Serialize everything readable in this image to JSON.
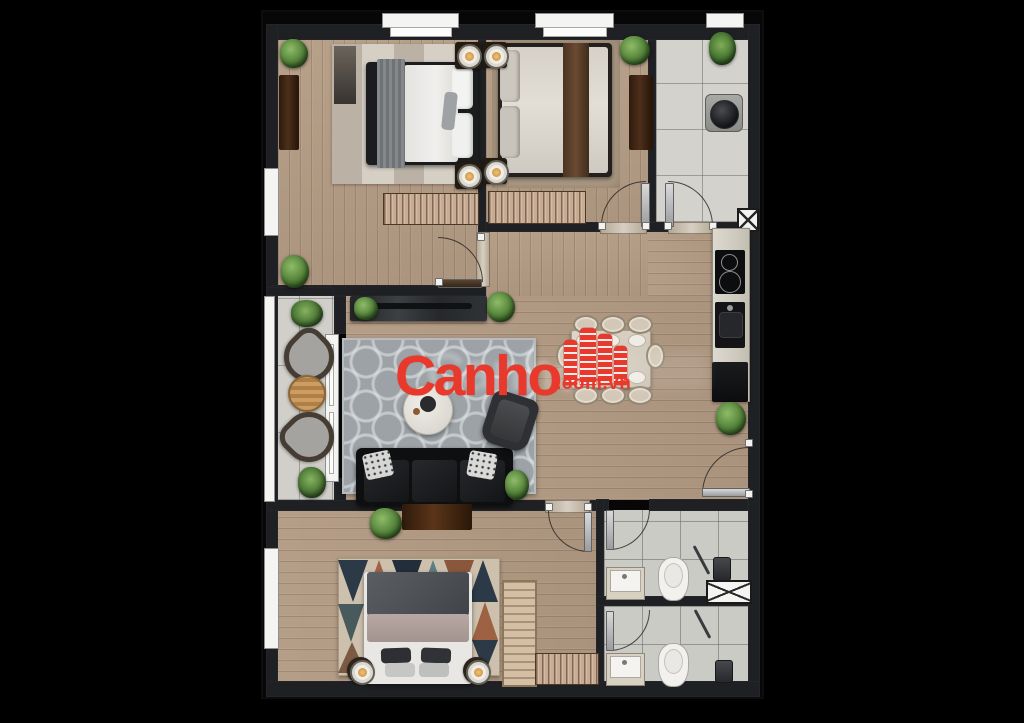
{
  "watermark": {
    "brand": "Canho",
    "suffix": ".com.vn",
    "ghost": "Canho",
    "brand_color": "#e8392c"
  },
  "palette": {
    "background": "#000000",
    "wall": "#1f2023",
    "wood_floor": "#b49c84",
    "tile_floor": "#d2d1cc",
    "bath_tile": "#cbcbc6",
    "rug_living": "#9ca2a6",
    "sofa_leather": "#151618",
    "threshold_marble": "#c9bfae",
    "plant_green": "#4f7e36",
    "window_white": "#f4f4f2"
  },
  "icons": [
    "plant-icon",
    "lamp-icon",
    "washer-icon",
    "toilet-icon",
    "sink-icon",
    "shower-icon",
    "cooktop-icon",
    "shaft-x-icon",
    "door-swing-icon",
    "window-icon"
  ]
}
